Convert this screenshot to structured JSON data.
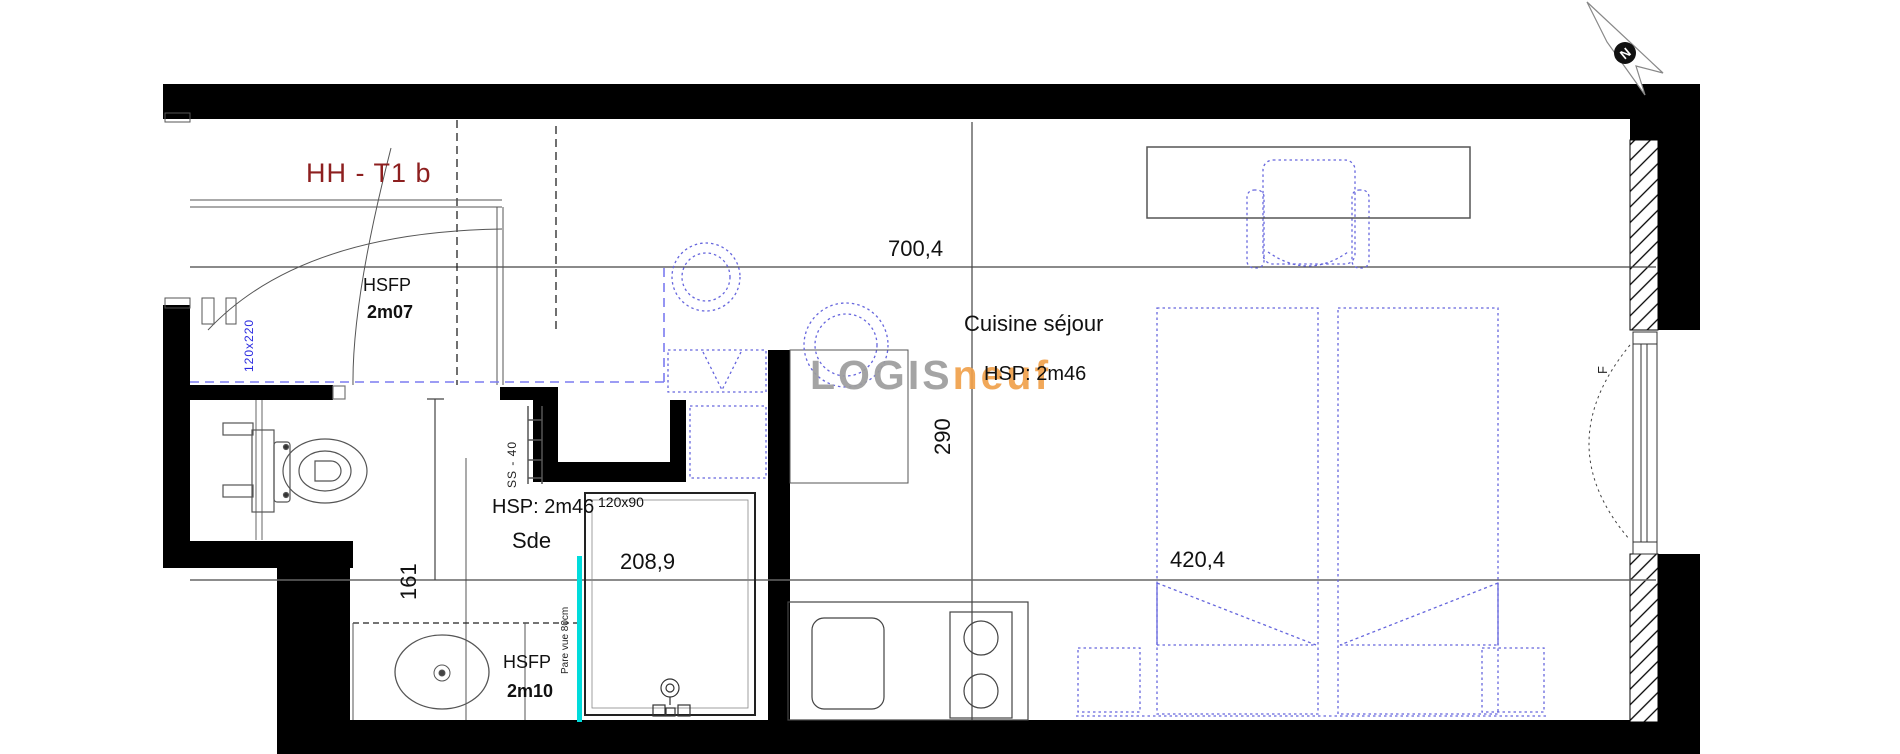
{
  "plan": {
    "title": "HH - T1 b",
    "north_label": "N",
    "watermark_gray": "LOGIS",
    "watermark_orange": "neuf"
  },
  "labels": {
    "entry_hsfp": "HSFP",
    "entry_hsfp_value": "2m07",
    "entry_door_size": "120x220",
    "total_width": "700,4",
    "living_name": "Cuisine séjour",
    "living_hsp": "HSP: 2m46",
    "kitchen_depth": "290",
    "sde_hsp": "HSP: 2m46",
    "shower_size": "120x90",
    "sde_name": "Sde",
    "sde_width": "208,9",
    "sde_depth": "161",
    "sde_hsfp": "HSFP",
    "sde_hsfp_value": "2m10",
    "privacy_screen": "Pare vue 80cm",
    "towel_rail": "SS - 40",
    "bed_width": "420,4",
    "window_label": "F"
  },
  "colors": {
    "title_red": "#8d1f1f",
    "watermark_gray": "#9d9d9d",
    "watermark_orange": "#f0a14c",
    "furniture_blue": "#6666dd",
    "screen_cyan": "#00dcdc",
    "door_label_blue": "#2a2ae0"
  }
}
